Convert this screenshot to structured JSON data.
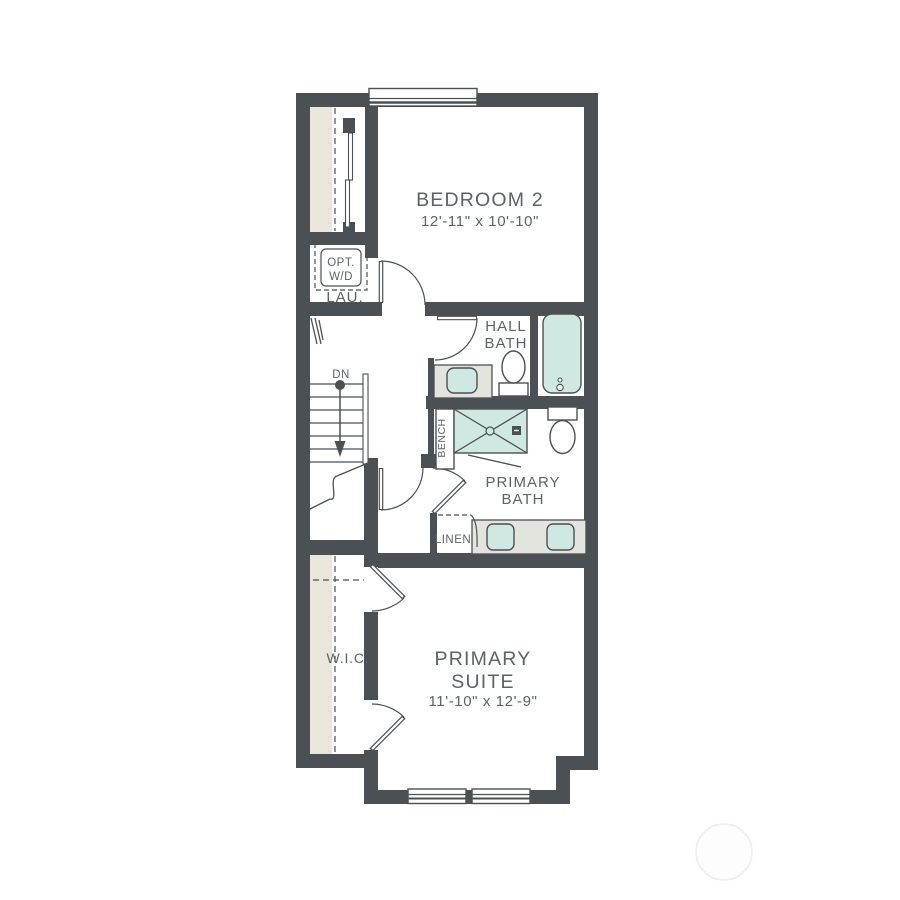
{
  "plan": {
    "type": "floor-plan",
    "level": "upper-floor"
  },
  "rooms": {
    "bedroom2": {
      "name": "BEDROOM 2",
      "dims": "12'-11\" x 10'-10\""
    },
    "primary_suite": {
      "line1": "PRIMARY",
      "line2": "SUITE",
      "dims": "11'-10\" x 12'-9\""
    },
    "hall_bath": {
      "line1": "HALL",
      "line2": "BATH"
    },
    "primary_bath": {
      "line1": "PRIMARY",
      "line2": "BATH"
    },
    "laundry": {
      "label": "LAU.",
      "opt_line1": "OPT.",
      "opt_line2": "W/D"
    },
    "wic": {
      "label": "W.I.C."
    },
    "linen": {
      "label": "LINEN"
    },
    "bench": {
      "label": "BENCH"
    },
    "stairs": {
      "label": "DN"
    }
  },
  "colors": {
    "wall": "#4b5054",
    "text": "#5d6266",
    "fixture": "#cfe9e2",
    "counter": "#e4e4de",
    "closet": "#eae6db",
    "watermark": "#ececec"
  }
}
